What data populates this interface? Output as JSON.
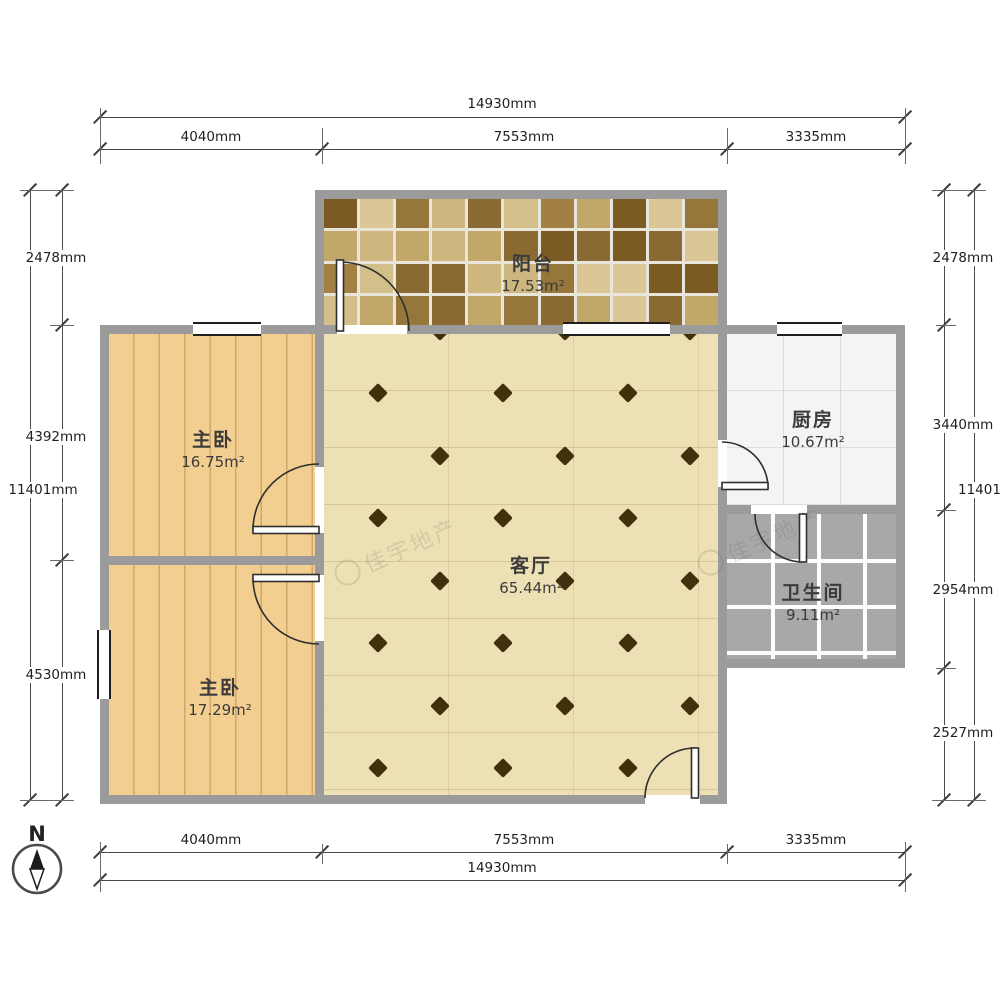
{
  "plan": {
    "rooms": [
      {
        "name": "阳台",
        "area": "17.53m²"
      },
      {
        "name": "主卧",
        "area": "16.75m²"
      },
      {
        "name": "厨房",
        "area": "10.67m²"
      },
      {
        "name": "客厅",
        "area": "65.44m²"
      },
      {
        "name": "卫生间",
        "area": "9.11m²"
      },
      {
        "name": "主卧",
        "area": "17.29m²"
      }
    ]
  },
  "dimensions": {
    "top": {
      "total": "14930mm",
      "segments": [
        "4040mm",
        "7553mm",
        "3335mm"
      ]
    },
    "bottom": {
      "total": "14930mm",
      "segments": [
        "4040mm",
        "7553mm",
        "3335mm"
      ]
    },
    "left": {
      "total": "11401mm",
      "segments": [
        "2478mm",
        "4392mm",
        "4530mm"
      ]
    },
    "right": {
      "total": "11401mm",
      "segments": [
        "2478mm",
        "3440mm",
        "2954mm",
        "2527mm"
      ]
    }
  },
  "compass": {
    "north_label": "N"
  },
  "watermark": {
    "text": "佳宇地产"
  },
  "colors": {
    "wall": "#9b9b9b",
    "wood_floor": "#f2cf90",
    "living_floor": "#ece0b4",
    "diamond_motif": "#42300d",
    "bath_tile": "#a8a8a8",
    "kitchen_tile": "#f4f4f2",
    "balcony_tile_dark": "#7c5a24",
    "balcony_tile_light": "#cdb77f"
  }
}
